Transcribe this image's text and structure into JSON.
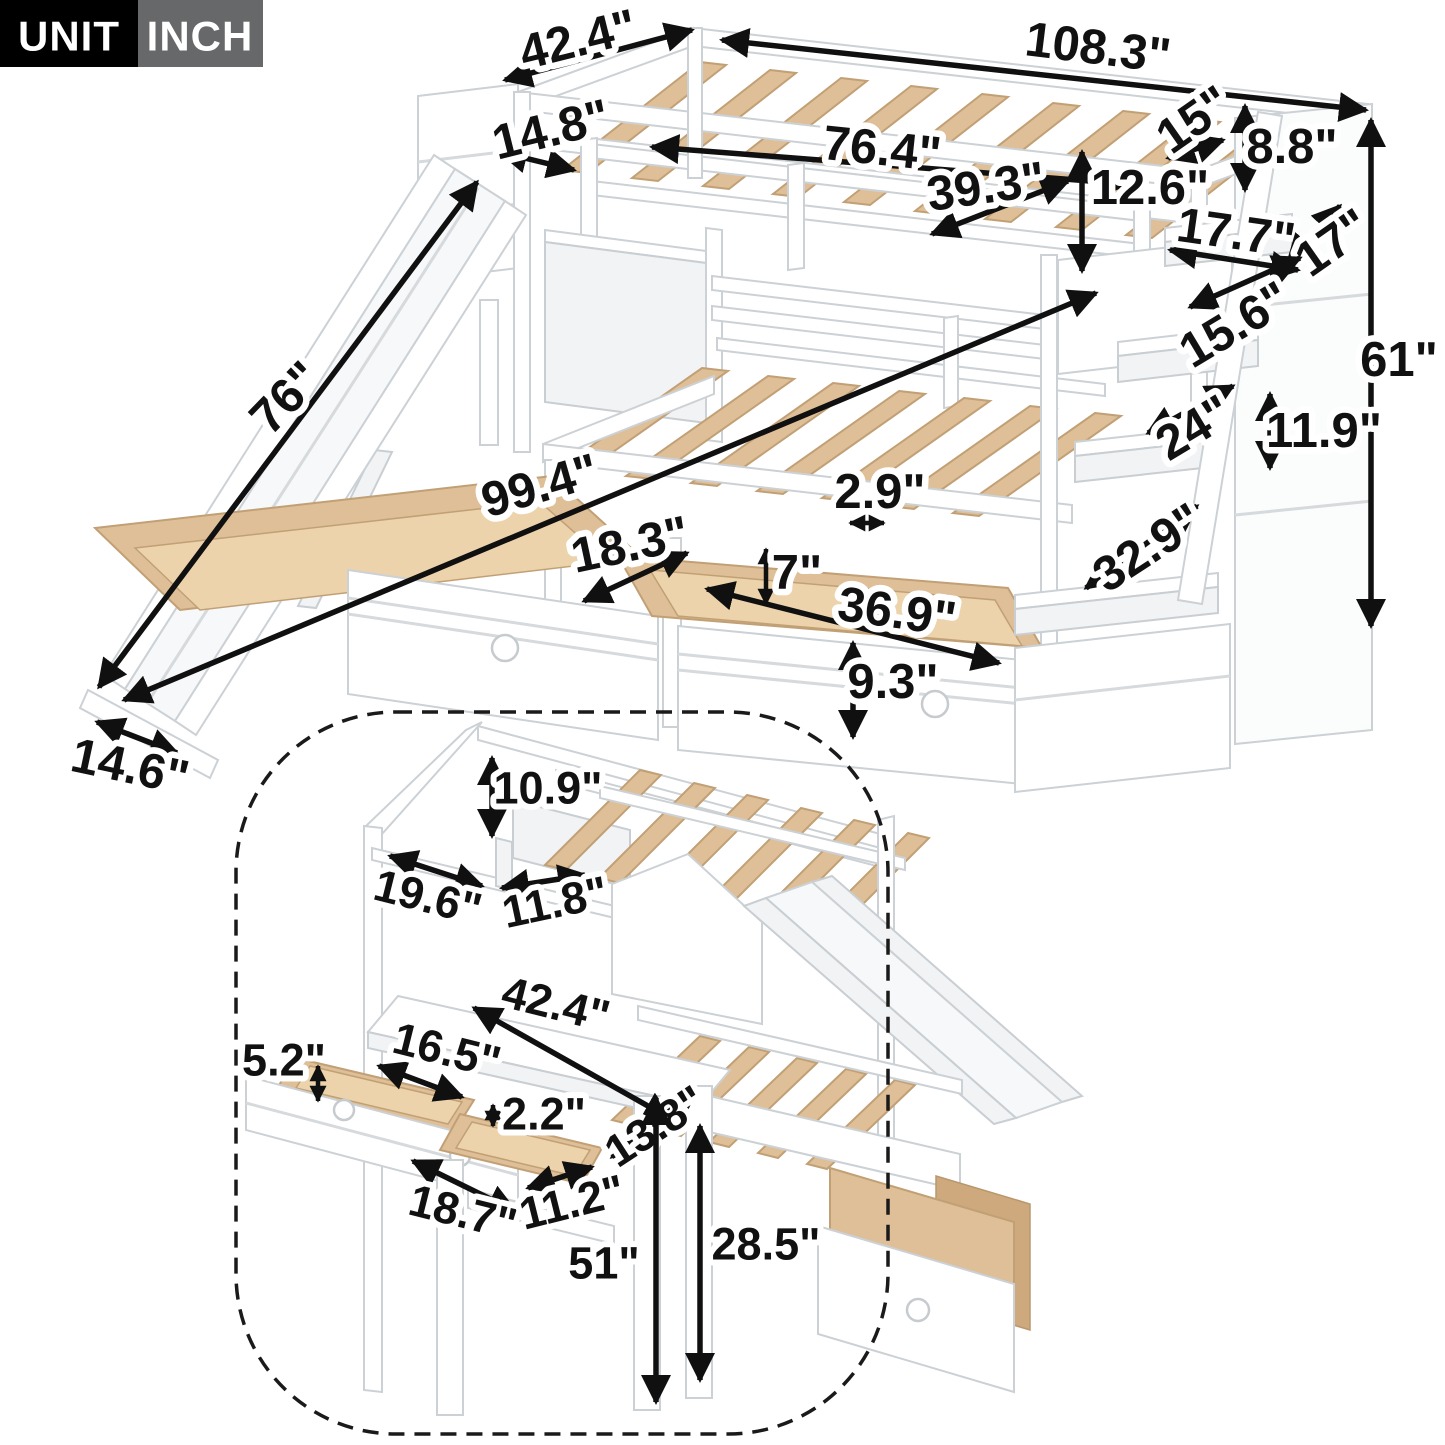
{
  "badge": {
    "unit_label": "UNIT",
    "unit_value": "INCH"
  },
  "colors": {
    "badge_black": "#000000",
    "badge_gray": "#66686a",
    "arrow_black": "#101010",
    "frame_white": "#ffffff",
    "frame_outline": "#ccd1d5",
    "wood": "#debf97"
  },
  "main_view": {
    "description": "bunk bed with slide, storage staircase and two under-bed drawers",
    "dimensions": [
      {
        "id": "head-top-width",
        "label": "42.4\""
      },
      {
        "id": "overall-length",
        "label": "108.3\""
      },
      {
        "id": "slide-platform-depth",
        "label": "14.8\""
      },
      {
        "id": "upper-bed-length",
        "label": "76.4\""
      },
      {
        "id": "upper-bed-width",
        "label": "39.3\""
      },
      {
        "id": "stair-top-gap",
        "label": "15\""
      },
      {
        "id": "guardrail-height",
        "label": "8.8\""
      },
      {
        "id": "upper-rail-height",
        "label": "12.6\""
      },
      {
        "id": "step-depth",
        "label": "17.7\""
      },
      {
        "id": "stair-side-width",
        "label": "17\""
      },
      {
        "id": "step-width",
        "label": "15.6\""
      },
      {
        "id": "overall-height",
        "label": "61\""
      },
      {
        "id": "stair-shelf-width",
        "label": "24\""
      },
      {
        "id": "shelf-opening-height",
        "label": "11.9\""
      },
      {
        "id": "slide-length",
        "label": "76\""
      },
      {
        "id": "floor-total-length",
        "label": "99.4\""
      },
      {
        "id": "slat-gap",
        "label": "2.9\""
      },
      {
        "id": "left-drawer-depth",
        "label": "18.3\""
      },
      {
        "id": "drawer-inner-height",
        "label": "7\""
      },
      {
        "id": "right-drawer-width",
        "label": "36.9\""
      },
      {
        "id": "drawer-front-height",
        "label": "9.3\""
      },
      {
        "id": "stair-storage-width",
        "label": "32.9\""
      },
      {
        "id": "slide-end-width",
        "label": "14.6\""
      }
    ]
  },
  "inset_view": {
    "description": "loft configuration with house roof shelf, desk and drawers",
    "dimensions": [
      {
        "id": "roof-height",
        "label": "10.9\""
      },
      {
        "id": "roof-shelf-width",
        "label": "19.6\""
      },
      {
        "id": "roof-shelf-depth",
        "label": "11.8\""
      },
      {
        "id": "desk-width",
        "label": "42.4\""
      },
      {
        "id": "desk-drawer-depth",
        "label": "16.5\""
      },
      {
        "id": "desk-drawer-height",
        "label": "5.2\""
      },
      {
        "id": "tray-inner-height",
        "label": "2.2\""
      },
      {
        "id": "bed-panel-height",
        "label": "13.8\""
      },
      {
        "id": "drawer-front-width",
        "label": "18.7\""
      },
      {
        "id": "tray-width",
        "label": "11.2\""
      },
      {
        "id": "desk-height",
        "label": "51\""
      },
      {
        "id": "underbed-clearance",
        "label": "28.5\""
      }
    ]
  }
}
